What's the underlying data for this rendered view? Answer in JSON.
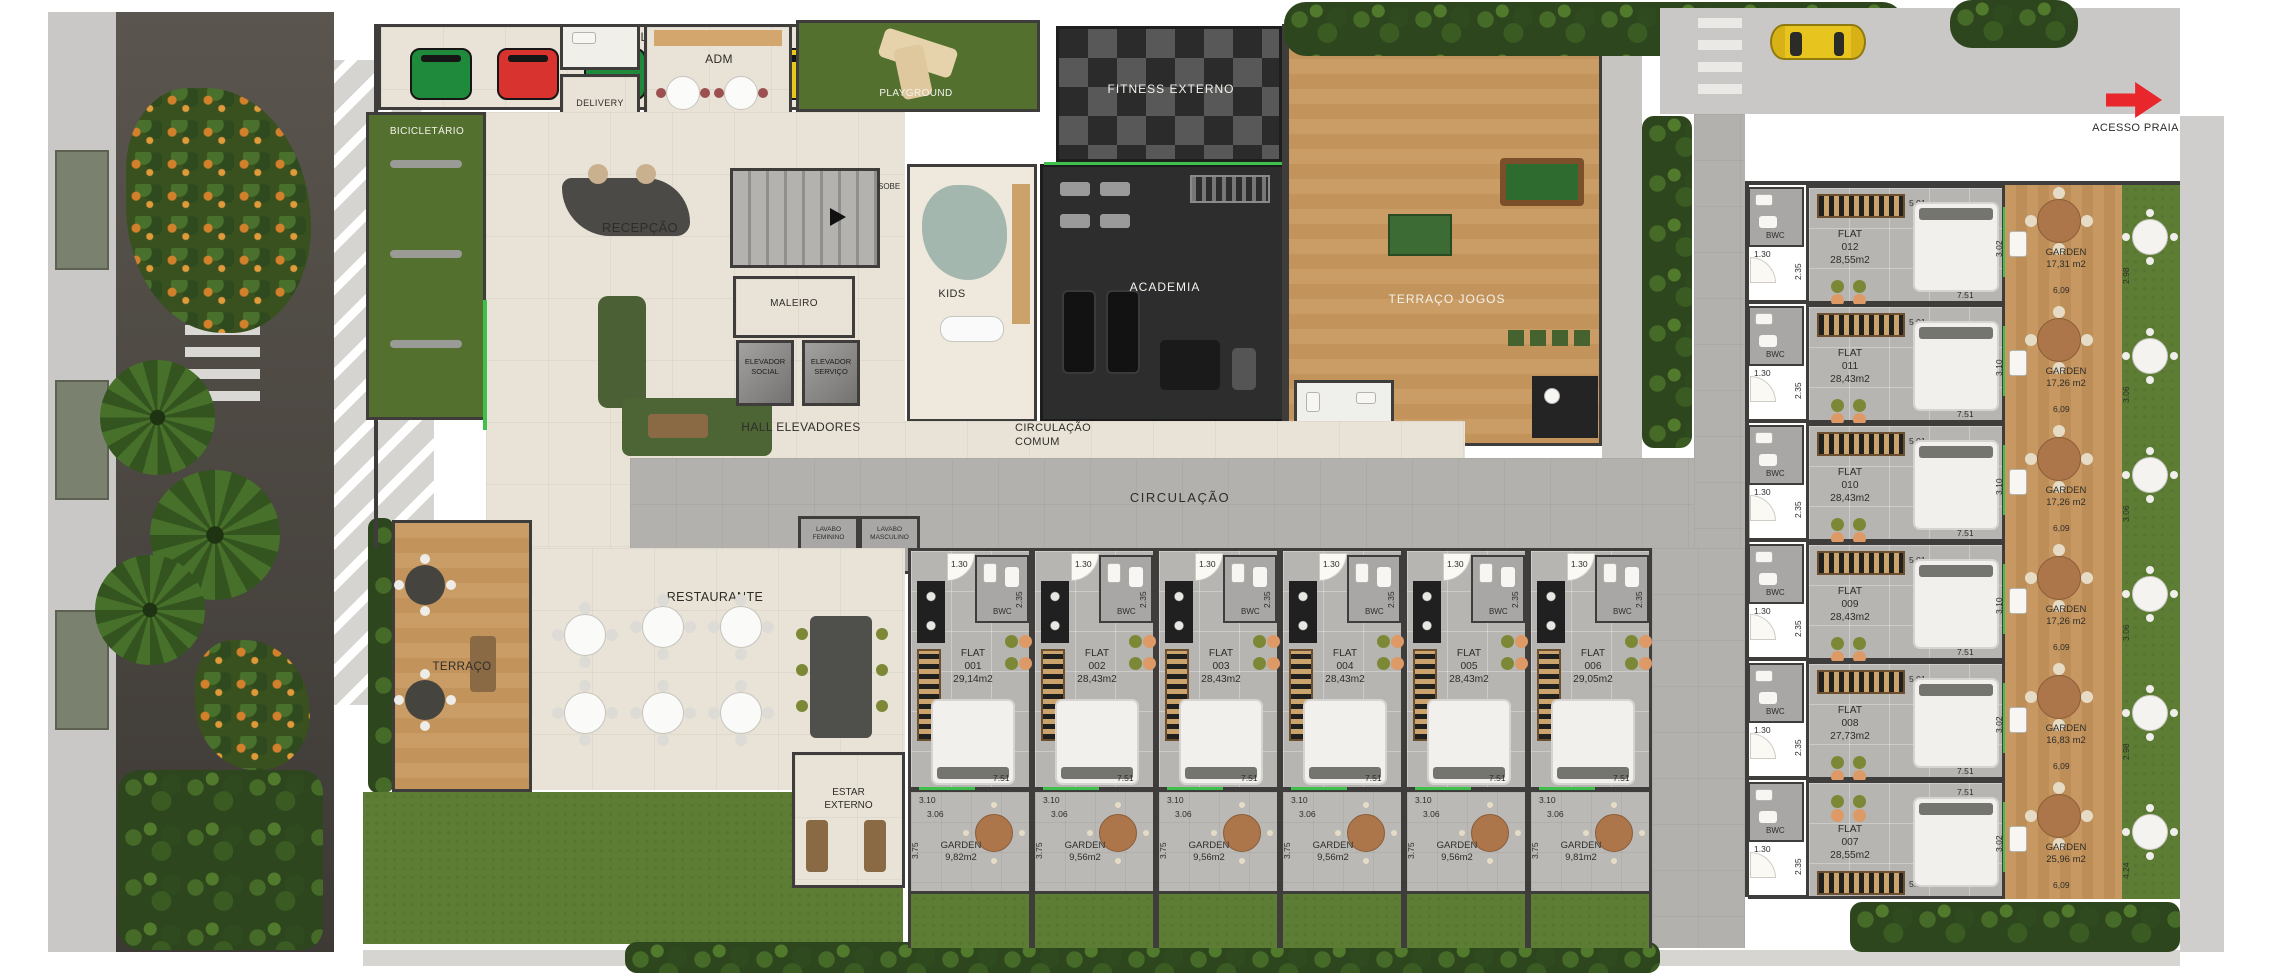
{
  "site": {
    "acesso_praia": "ACESSO PRAIA"
  },
  "rooms": {
    "lixo": "LIXO",
    "bicicletario": "BICICLETÁRIO",
    "delivery": "DELIVERY",
    "adm": "ADM",
    "recepcao": "RECEPÇÃO",
    "playground": "PLAYGROUND",
    "fitness_externo": "FITNESS EXTERNO",
    "kids": "KIDS",
    "academia": "ACADEMIA",
    "terraco_jogos": "TERRAÇO JOGOS",
    "maleiro": "MALEIRO",
    "sobe": "SOBE",
    "elevador": "ELEVADOR",
    "social": "SOCIAL",
    "servico": "SERVIÇO",
    "hall_elevadores": "HALL ELEVADORES",
    "circulacao": "CIRCULAÇÃO",
    "comum": "COMUM",
    "lavabo": "LAVABO",
    "feminino": "FEMININO",
    "masculino": "MASCULINO",
    "restaurante": "RESTAURANTE",
    "terraco": "TERRAÇO",
    "estar": "ESTAR",
    "externo": "EXTERNO",
    "bwc": "BWC",
    "flat": "FLAT",
    "garden": "GARDEN"
  },
  "dims": {
    "w130": "1.30",
    "w235": "2.35",
    "w143": "1.43 ↓",
    "w501": "5.01",
    "w751": "7.51",
    "w310": "3.10",
    "w306": "3.06",
    "w375": "3.75",
    "w609": "6,09"
  },
  "flats_bottom": [
    {
      "number": "001",
      "area": "29,14m2",
      "garden_area": "9,82m2"
    },
    {
      "number": "002",
      "area": "28,43m2",
      "garden_area": "9,56m2"
    },
    {
      "number": "003",
      "area": "28,43m2",
      "garden_area": "9,56m2"
    },
    {
      "number": "004",
      "area": "28,43m2",
      "garden_area": "9,56m2"
    },
    {
      "number": "005",
      "area": "28,43m2",
      "garden_area": "9,56m2"
    },
    {
      "number": "006",
      "area": "29,05m2",
      "garden_area": "9,81m2"
    }
  ],
  "flats_right": [
    {
      "number": "012",
      "area": "28,55m2",
      "garden_area": "17,31 m2",
      "depth": "3.02",
      "lawn": "2.98"
    },
    {
      "number": "011",
      "area": "28,43m2",
      "garden_area": "17,26 m2",
      "depth": "3.10",
      "lawn": "3.06"
    },
    {
      "number": "010",
      "area": "28,43m2",
      "garden_area": "17,26 m2",
      "depth": "3.10",
      "lawn": "3.06"
    },
    {
      "number": "009",
      "area": "28,43m2",
      "garden_area": "17,26 m2",
      "depth": "3.10",
      "lawn": "3.06"
    },
    {
      "number": "008",
      "area": "27,73m2",
      "garden_area": "16,83 m2",
      "depth": "3.02",
      "lawn": "2.98"
    },
    {
      "number": "007",
      "area": "28,55m2",
      "garden_area": "25,96 m2",
      "depth": "3.02",
      "lawn": "4.24"
    }
  ],
  "colors": {
    "accent_glass_green": "#3fbf4b",
    "arrow_red": "#e8262c",
    "turf_green": "#53702f",
    "lawn_green": "#5d7d35",
    "deck_wood": "#c79862",
    "gym_dark": "#2d2d2d",
    "bins": [
      "#1f8a3c",
      "#d8332e",
      "#1f8a3c",
      "#d8332e",
      "#eac819",
      "#2c3f9a"
    ]
  }
}
